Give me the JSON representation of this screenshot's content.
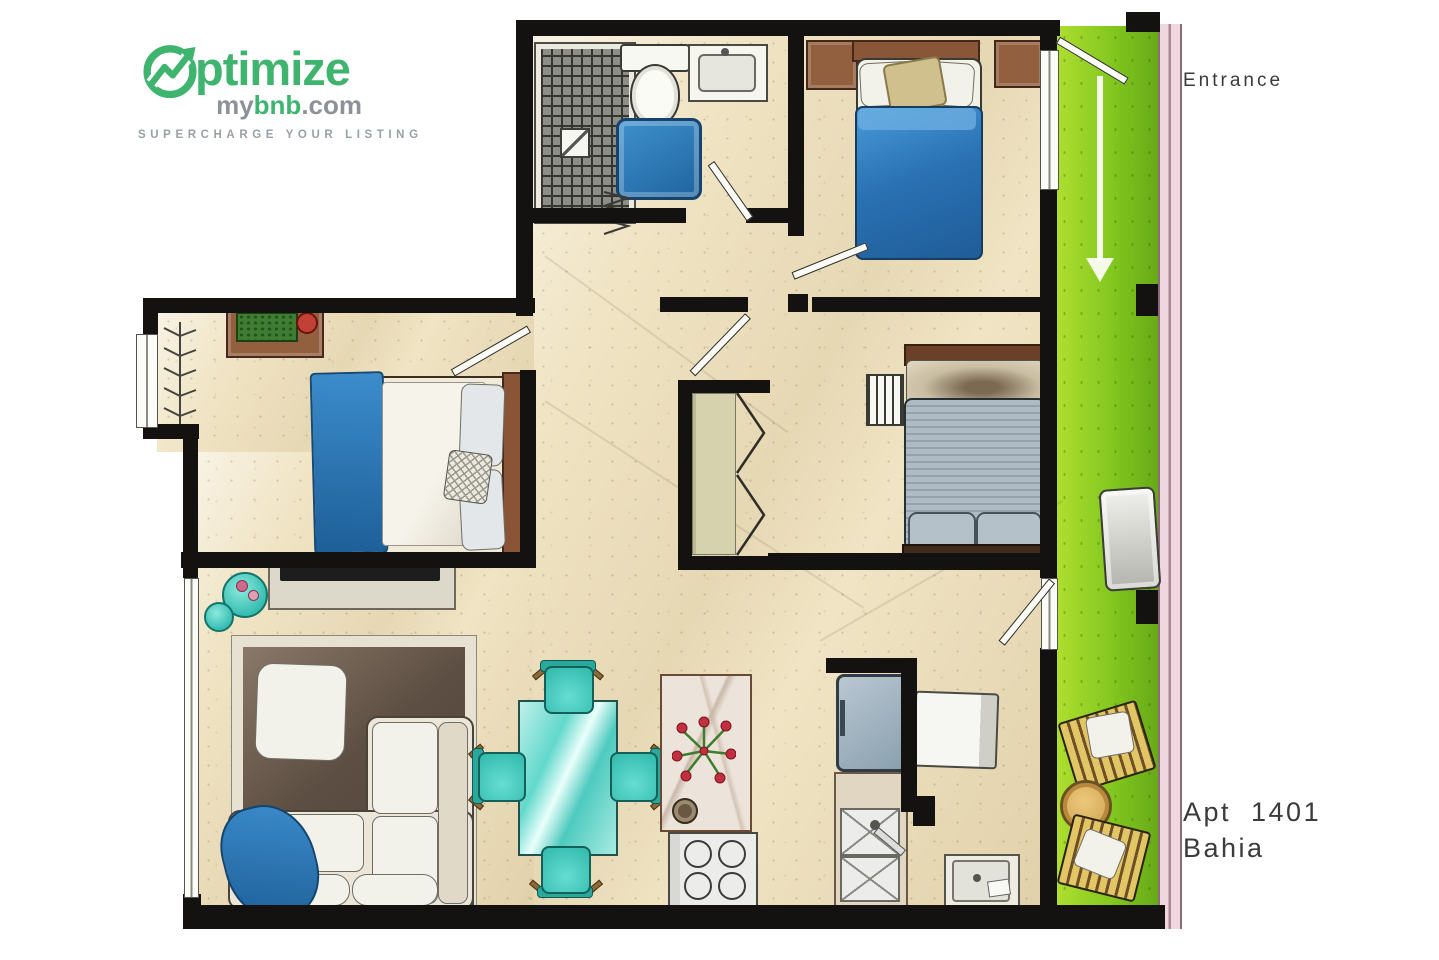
{
  "logo": {
    "optimize_text": "ptimize",
    "my": "my",
    "bnb": "bnb",
    "dotcom": ".com",
    "tagline": "SUPERCHARGE YOUR LISTING"
  },
  "labels": {
    "entrance": "Entrance",
    "apt_line1": "Apt 1401",
    "apt_line2": "Bahia"
  },
  "colors": {
    "logo_green": "#3fb46f",
    "logo_gray": "#8d929a",
    "wall": "#141210",
    "floor": "#f0e4c4",
    "balcony_green": "#8fd122",
    "railing_pink": "#eed7de",
    "bed_blue": "#2f80c0",
    "teal": "#47d0c2",
    "rug_brown": "#4e4236",
    "wood_brown": "#93603f",
    "duvet_gray": "#a7b4bd",
    "label_ink": "#3b3b3b"
  },
  "icons": {
    "logo_mark": "growth-arrow-circle",
    "entrance_arrow": "down-arrow",
    "bathroom": [
      "tiled-shower",
      "toilet",
      "vanity-sink",
      "bath-mat",
      "towel-rail"
    ],
    "bedrooms": [
      "double-bed-blue",
      "double-bed-white-blue",
      "double-bed-gray",
      "nightstand",
      "dresser",
      "coat-rack",
      "towel-ladder",
      "wardrobe-bifold"
    ],
    "living": [
      "tv-console",
      "sectional-sofa",
      "area-rug",
      "throw-blanket",
      "round-side-table"
    ],
    "dining": [
      "glass-table",
      "dining-chair"
    ],
    "kitchen": [
      "island-counter",
      "tulip-bouquet",
      "cooktop",
      "fridge",
      "double-sink",
      "washer",
      "utility-sink"
    ],
    "balcony": [
      "bench-unit",
      "lounge-chair",
      "round-wicker-table"
    ]
  }
}
